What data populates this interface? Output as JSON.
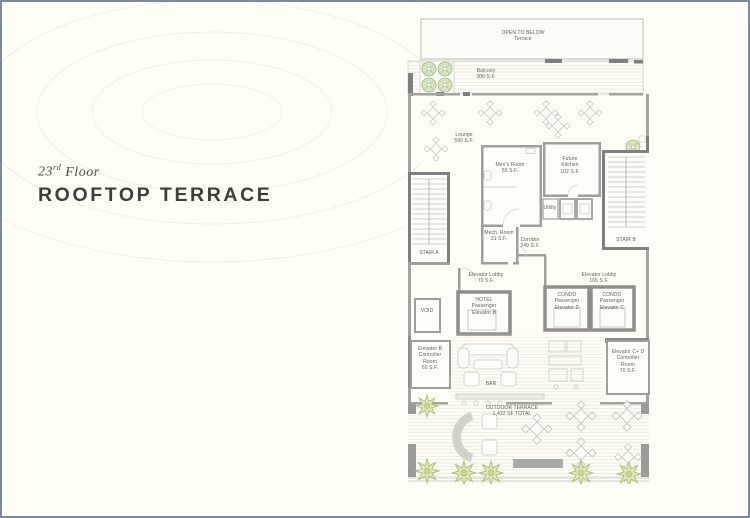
{
  "header": {
    "floor_number": "23",
    "floor_ordinal": "rd",
    "floor_word": "Floor",
    "title": "ROOFTOP TERRACE"
  },
  "colors": {
    "page_background": "#fffef6",
    "page_border": "#7b89a0",
    "title_text": "#3d3d3a",
    "wall_gray": "#9e9e9a",
    "wall_dark": "#7f7f7d",
    "plant_green": "#e2e9bb",
    "label_text": "#5e5e58"
  },
  "plan": {
    "labels": {
      "open_to_below": [
        "OPEN TO BELOW",
        "Terrace"
      ],
      "balcony": [
        "Balcony",
        "306 S.F."
      ],
      "lounge": [
        "Lounge",
        "590 S.F."
      ],
      "mens_room": [
        "Men's Room",
        "55 S.F."
      ],
      "future_kitchen": [
        "Future",
        "Kitchen",
        "102 S.F."
      ],
      "stair_a": [
        "STAIR A"
      ],
      "stair_b": [
        "STAIR B"
      ],
      "mech_room": [
        "Mech. Room",
        "31 S.F."
      ],
      "corridor": [
        "Corridor",
        "249 S.F."
      ],
      "utility": [
        "Utility"
      ],
      "elevator_lobby_hotel": [
        "Elevator Lobby",
        "70 S.F."
      ],
      "elevator_lobby_condo": [
        "Elevator Lobby",
        "165 S.F."
      ],
      "void": [
        "VOID"
      ],
      "hotel_elevator_b": [
        "HOTEL",
        "Passenger",
        "Elevator B"
      ],
      "condo_elevator_d": [
        "CONDO",
        "Passenger",
        "Elevator D"
      ],
      "condo_elevator_c": [
        "CONDO",
        "Passenger",
        "Elevator C"
      ],
      "elevator_b_controller": [
        "Elevator B",
        "Controller",
        "Room",
        "60 S.F."
      ],
      "elevator_cd_controller": [
        "Elevator C+ D",
        "Controller",
        "Room",
        "70 S.F."
      ],
      "bar": [
        "BAR"
      ],
      "outdoor_terrace": [
        "OUTDOOR TERRACE",
        "1,432 SF TOTAL"
      ]
    }
  }
}
